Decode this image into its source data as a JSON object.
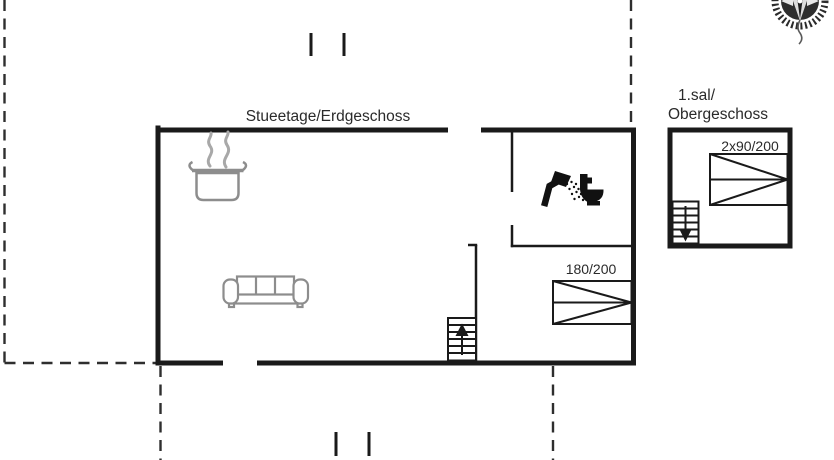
{
  "plan": {
    "ground_floor": {
      "title": "Stueetage/Erdgeschoss",
      "double_bed_label": "180/200"
    },
    "upper_floor": {
      "title_line1": "1.sal/",
      "title_line2": "Obergeschoss",
      "double_bed_label": "2x90/200"
    },
    "colors": {
      "wall": "#1a1a1a",
      "furniture": "#8d8d8d",
      "steam": "#a8a8a8",
      "background": "#ffffff"
    },
    "icons": [
      "compass-icon",
      "cooking-pot-icon",
      "steam-icon",
      "sofa-icon",
      "shower-icon",
      "toilet-icon",
      "stairs-up-arrow-icon",
      "stairs-down-arrow-icon",
      "double-bed-symbol",
      "property-boundary-dashes",
      "road-tick-marks"
    ]
  }
}
